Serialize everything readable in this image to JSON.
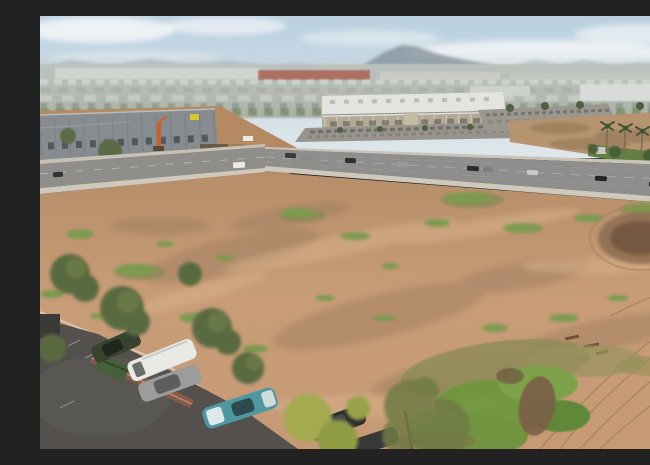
{
  "meta": {
    "alt": "Aerial drone photograph of a large vacant graded dirt lot bordered by arterial roads; a gray tilt-up concrete building under construction with an orange boom lift on the left; a white retail shopping center with a full parking lot across the road; a second cleared parcel lined with palm trees on the right; a small parking lot with cars, trees and a brick dumpster enclosure in the lower-left foreground; hazy mountains and low cityscape on the horizon under a pale blue sky with thin clouds.",
    "type": "aerial-photograph"
  },
  "palette": {
    "sky_top": "#b9d0e0",
    "sky_horizon": "#dfe7ea",
    "cloud": "#f2f5f6",
    "mountain_main": "#86929e",
    "mountain_far": "#9fabb5",
    "distant_city": "#b7bdb4",
    "red_building_strip": "#aa6152",
    "dirt_light": "#cba07c",
    "dirt_base": "#bd9472",
    "dirt_smudge": "#9a7a5f",
    "road_asphalt": "#8e8e8c",
    "sidewalk": "#cfc8bc",
    "parking_asphalt": "#53504d",
    "concrete_walls": "#878c90",
    "retail_roof": "#e3e4df",
    "retail_facade": "#b3a995",
    "tree_green": "#5a6b3f",
    "weed_green": "#7d9a4f",
    "weed_olive": "#8d8a57",
    "bright_patch_green": "#70973f",
    "grass_strip": "#647e45",
    "brick_wall": "#8a5a48",
    "dumpster_green": "#46603b",
    "teal_car": "#4f98a0",
    "white_van": "#e9e9e5",
    "orange_lift": "#cf5f22",
    "yellow_sign": "#d9c72f",
    "basin_dark": "#73573f",
    "concrete_ramp": "#ddd9d1",
    "watermark_white": "#ffffff"
  },
  "watermark": {
    "icon": "costar-pinwheel-watermark-icon",
    "opacity": 0.55
  }
}
